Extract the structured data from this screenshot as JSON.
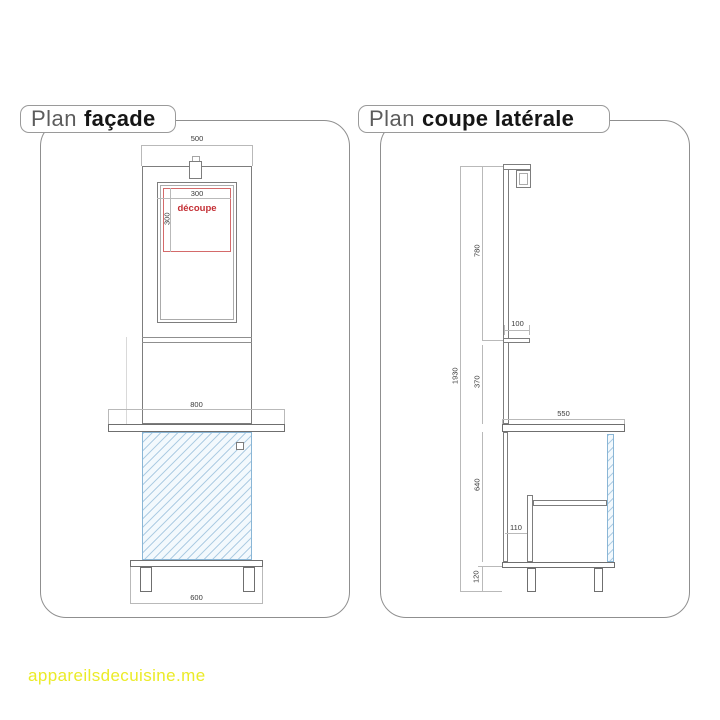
{
  "panels": {
    "facade": {
      "title_prefix": "Plan",
      "title_name": "façade",
      "cutout_label": "découpe",
      "dims": {
        "top_width": "500",
        "cutout_width": "300",
        "cutout_height": "300",
        "worktop_width": "800",
        "base_width": "600"
      }
    },
    "coupe": {
      "title_prefix": "Plan",
      "title_name": "coupe latérale",
      "dims": {
        "upper_height": "780",
        "total_height": "1930",
        "shelf_depth": "100",
        "mid_height": "370",
        "worktop_depth": "550",
        "cabinet_height": "640",
        "inner_offset": "110",
        "leg_height": "120"
      }
    }
  },
  "watermark": {
    "text": "appareilsdecuisine.me"
  },
  "colors": {
    "line_gray": "#8f8f8f",
    "dim_gray": "#b9b9b9",
    "cutout_red": "#c42f35",
    "hatch_blue": "#8ab6d6",
    "watermark_yellow": "#ebeb28"
  }
}
